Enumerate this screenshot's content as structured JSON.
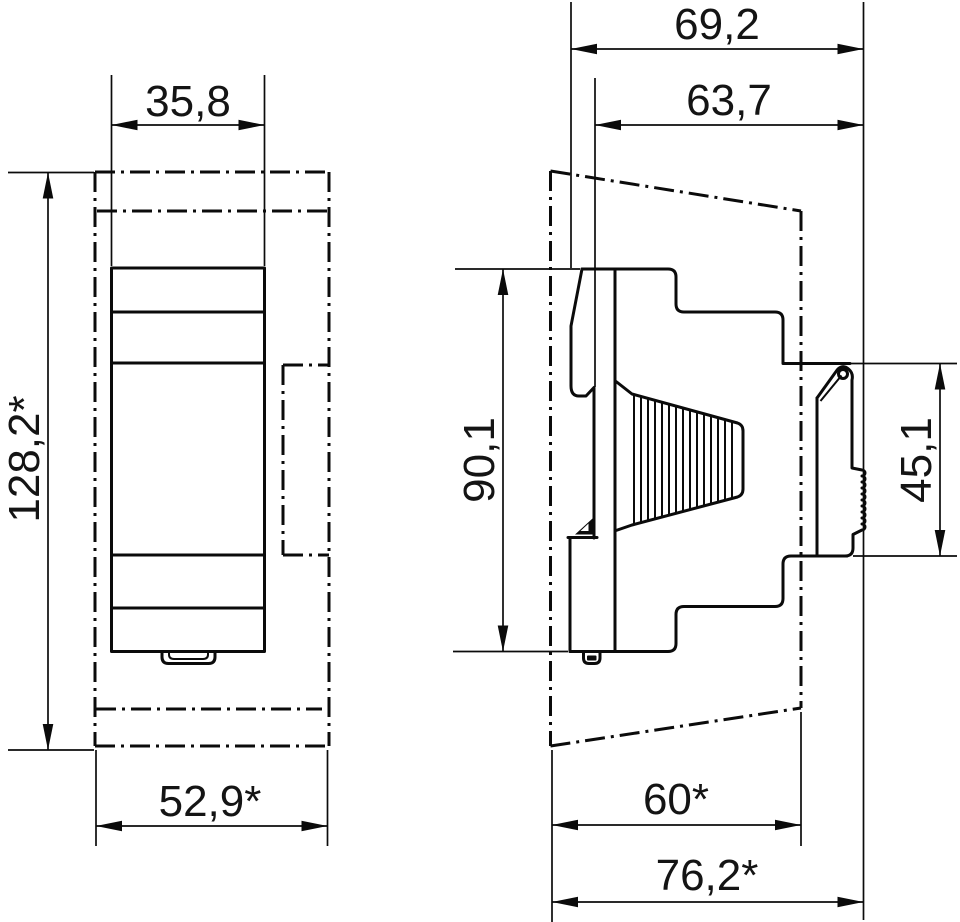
{
  "colors": {
    "ink": "#0b0b0b",
    "paper": "#ffffff"
  },
  "front_view": {
    "dim_top_width": "35,8",
    "dim_height": "128,2*",
    "dim_envelope_width": "52,9*"
  },
  "side_view": {
    "dim_total_depth": "69,2",
    "dim_body_depth": "63,7",
    "dim_body_height": "90,1",
    "dim_rail_height": "45,1",
    "dim_envelope_depth": "60*",
    "dim_envelope_total_depth": "76,2*"
  }
}
